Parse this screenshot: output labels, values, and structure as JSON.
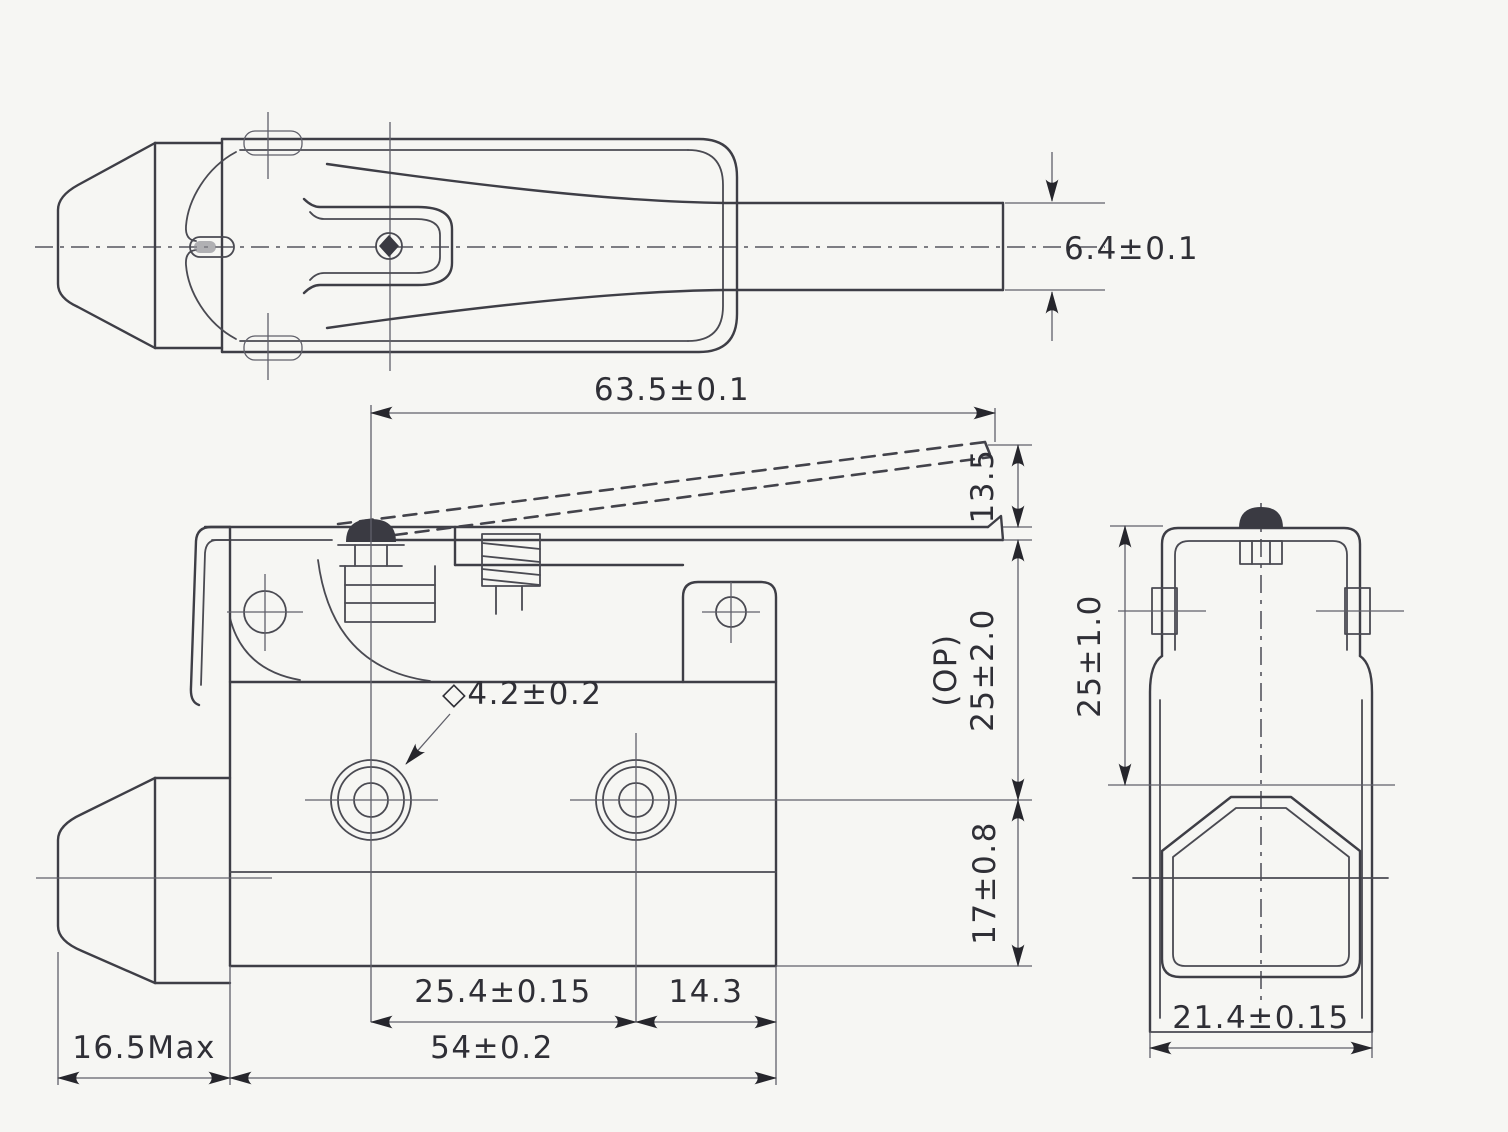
{
  "top_view": {
    "lever_width": "6.4±0.1"
  },
  "front_view": {
    "lever_length": "63.5±0.1",
    "free_position_height": "13.5",
    "op_prefix": "(OP)",
    "operating_height": "25±2.0",
    "base_height": "17±0.8",
    "mount_hole_diameter": "◇4.2±0.2",
    "mount_hole_spacing": "25.4±0.15",
    "hole_to_edge": "14.3",
    "body_width": "54±0.2",
    "boot_max_length": "16.5Max"
  },
  "side_view": {
    "body_height": "25±1.0",
    "body_depth": "21.4±0.15"
  },
  "colors": {
    "background": "#f6f6f3",
    "line": "#3e3e46",
    "thin_line": "#60606a",
    "text": "#2f2f36"
  }
}
